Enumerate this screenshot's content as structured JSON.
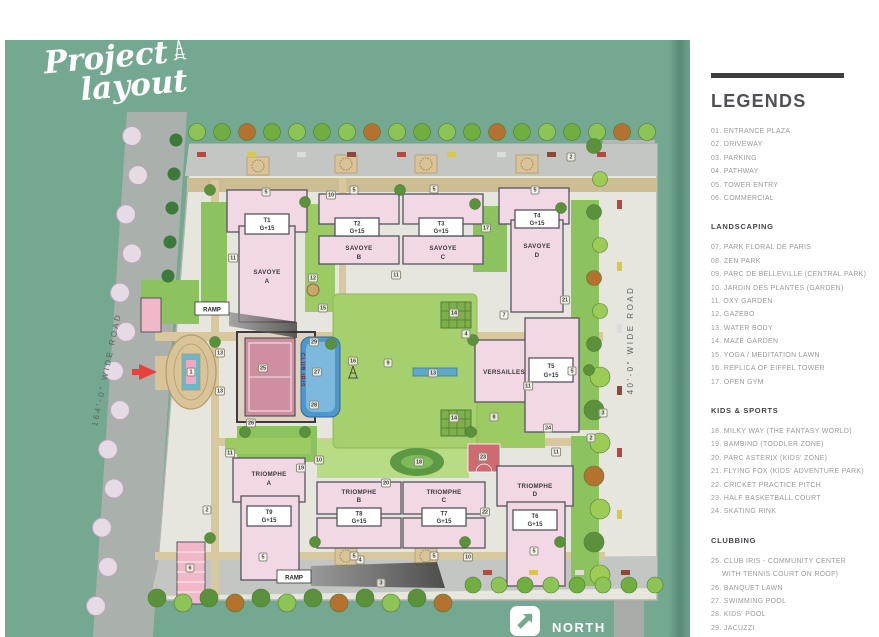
{
  "page": {
    "title_line1": "Project",
    "title_line2": "layout"
  },
  "legend": {
    "title": "LEGENDS",
    "sections": [
      {
        "heading": "",
        "items": [
          "01. ENTRANCE PLAZA",
          "02. DRIVEWAY",
          "03. PARKING",
          "04. PATHWAY",
          "05. TOWER ENTRY",
          "06. COMMERCIAL"
        ]
      },
      {
        "heading": "LANDSCAPING",
        "items": [
          "07. PARK FLORAL DE PARIS",
          "08. ZEN PARK",
          "09. PARC DE BELLEVILLE (CENTRAL PARK)",
          "10. JARDIN DES PLANTES (GARDEN)",
          "11. OXY GARDEN",
          "12. GAZEBO",
          "13. WATER BODY",
          "14. MAZE GARDEN",
          "15. YOGA / MEDITATION LAWN",
          "16. REPLICA OF EIFFEL TOWER",
          "17. OPEN GYM"
        ]
      },
      {
        "heading": "KIDS & SPORTS",
        "items": [
          "18. MILKY WAY (THE FANTASY WORLD)",
          "19. BAMBINO (TODDLER ZONE)",
          "20. PARC ASTERIX (KIDS' ZONE)",
          "21. FLYING FOX (KIDS' ADVENTURE PARK)",
          "22. CRICKET PRACTICE PITCH",
          "23. HALF BASKETBALL COURT",
          "24. SKATING RINK"
        ]
      },
      {
        "heading": "CLUBBING",
        "items": [
          "25. CLUB IRIS - COMMUNITY CENTER WITH TENNIS COURT ON ROOF)",
          "26. BANQUET LAWN",
          "27. SWIMMING POOL",
          "28. KIDS' POOL",
          "29. JACUZZI"
        ]
      }
    ]
  },
  "map": {
    "north_label": "NORTH",
    "left_road_label": "164'-0\" WIDE ROAD",
    "right_road_label": "40'-0\" WIDE ROAD",
    "ramp_label": "RAMP",
    "club_label": "CLUB IRIS",
    "towers": {
      "t1": {
        "code": "T1",
        "floors": "G+15",
        "family": "SAVOYE",
        "unit": "A"
      },
      "t2": {
        "code": "T2",
        "floors": "G+15",
        "family": "SAVOYE",
        "unit": "B"
      },
      "t3": {
        "code": "T3",
        "floors": "G+15",
        "family": "SAVOYE",
        "unit": "C"
      },
      "t4": {
        "code": "T4",
        "floors": "G+15",
        "family": "SAVOYE",
        "unit": "D"
      },
      "t5": {
        "code": "T5",
        "floors": "G+15"
      },
      "versailles": {
        "name": "VERSAILLES"
      },
      "t6": {
        "code": "T6",
        "floors": "G+15",
        "family": "TRIOMPHE",
        "unit": "D"
      },
      "t7": {
        "code": "T7",
        "floors": "G+15",
        "family": "TRIOMPHE",
        "unit": "C"
      },
      "t8": {
        "code": "T8",
        "floors": "G+15",
        "family": "TRIOMPHE",
        "unit": "B"
      },
      "t9": {
        "code": "T9",
        "floors": "G+15",
        "family": "TRIOMPHE",
        "unit": "A"
      }
    },
    "markers": [
      {
        "n": "1",
        "x": 186,
        "y": 332
      },
      {
        "n": "2",
        "x": 566,
        "y": 117
      },
      {
        "n": "2",
        "x": 202,
        "y": 470
      },
      {
        "n": "2",
        "x": 586,
        "y": 398
      },
      {
        "n": "3",
        "x": 376,
        "y": 543
      },
      {
        "n": "3",
        "x": 598,
        "y": 373
      },
      {
        "n": "4",
        "x": 461,
        "y": 294
      },
      {
        "n": "4",
        "x": 355,
        "y": 520
      },
      {
        "n": "5",
        "x": 261,
        "y": 152
      },
      {
        "n": "5",
        "x": 349,
        "y": 150
      },
      {
        "n": "5",
        "x": 429,
        "y": 149
      },
      {
        "n": "5",
        "x": 530,
        "y": 150
      },
      {
        "n": "5",
        "x": 258,
        "y": 517
      },
      {
        "n": "5",
        "x": 349,
        "y": 516
      },
      {
        "n": "5",
        "x": 429,
        "y": 516
      },
      {
        "n": "5",
        "x": 529,
        "y": 511
      },
      {
        "n": "5",
        "x": 567,
        "y": 331
      },
      {
        "n": "6",
        "x": 185,
        "y": 528
      },
      {
        "n": "7",
        "x": 499,
        "y": 275
      },
      {
        "n": "8",
        "x": 489,
        "y": 377
      },
      {
        "n": "9",
        "x": 383,
        "y": 323
      },
      {
        "n": "10",
        "x": 326,
        "y": 155
      },
      {
        "n": "10",
        "x": 314,
        "y": 420
      },
      {
        "n": "10",
        "x": 463,
        "y": 517
      },
      {
        "n": "11",
        "x": 228,
        "y": 218
      },
      {
        "n": "11",
        "x": 391,
        "y": 235
      },
      {
        "n": "11",
        "x": 523,
        "y": 346
      },
      {
        "n": "11",
        "x": 225,
        "y": 413
      },
      {
        "n": "11",
        "x": 551,
        "y": 412
      },
      {
        "n": "12",
        "x": 308,
        "y": 238
      },
      {
        "n": "13",
        "x": 215,
        "y": 313
      },
      {
        "n": "13",
        "x": 215,
        "y": 351
      },
      {
        "n": "13",
        "x": 428,
        "y": 333
      },
      {
        "n": "14",
        "x": 449,
        "y": 273
      },
      {
        "n": "14",
        "x": 449,
        "y": 378
      },
      {
        "n": "15",
        "x": 318,
        "y": 268
      },
      {
        "n": "16",
        "x": 348,
        "y": 321
      },
      {
        "n": "17",
        "x": 481,
        "y": 188
      },
      {
        "n": "18",
        "x": 414,
        "y": 422
      },
      {
        "n": "19",
        "x": 296,
        "y": 428
      },
      {
        "n": "20",
        "x": 381,
        "y": 443
      },
      {
        "n": "21",
        "x": 560,
        "y": 260
      },
      {
        "n": "22",
        "x": 480,
        "y": 472
      },
      {
        "n": "23",
        "x": 478,
        "y": 417
      },
      {
        "n": "24",
        "x": 543,
        "y": 388
      },
      {
        "n": "25",
        "x": 258,
        "y": 328
      },
      {
        "n": "26",
        "x": 246,
        "y": 383
      },
      {
        "n": "27",
        "x": 312,
        "y": 332
      },
      {
        "n": "28",
        "x": 309,
        "y": 365
      },
      {
        "n": "29",
        "x": 309,
        "y": 302
      }
    ]
  },
  "colors": {
    "background_teal": "#74a890",
    "building_pink": "#f1d8e4",
    "accent_red": "#e8413c",
    "legend_bar": "#3d3d42",
    "pool_blue": "#4e96cc",
    "lawn_green": "#a6d06e"
  }
}
